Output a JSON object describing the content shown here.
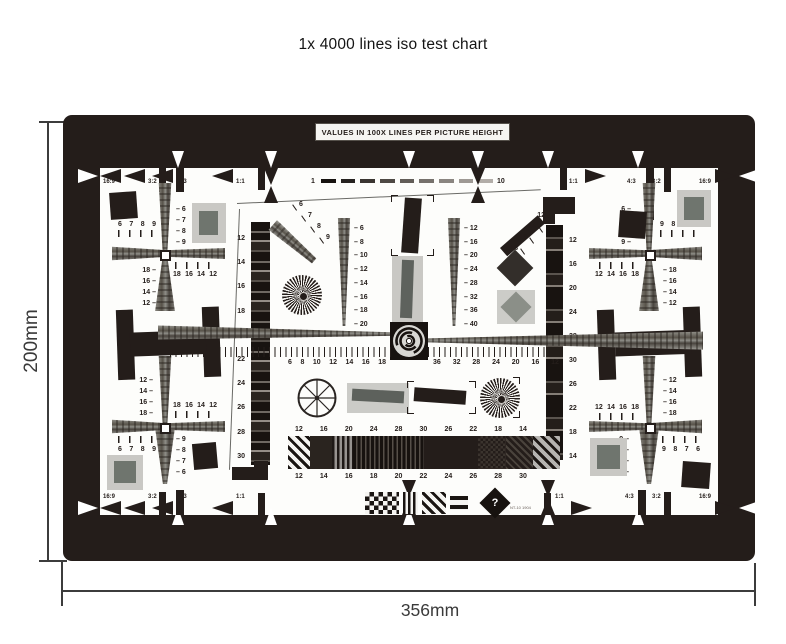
{
  "title": "1x 4000 lines iso test chart",
  "dimensions": {
    "height": "200mm",
    "width": "356mm"
  },
  "chart": {
    "header": "VALUES IN 100X LINES PER PICTURE HEIGHT",
    "scale": {
      "start": "1",
      "end": "10"
    },
    "aspect": {
      "a169": "16:9",
      "a32": "3:2",
      "a43": "4:3",
      "a11": "1:1"
    },
    "corners": {
      "tl": {
        "nw": [
          "6",
          "7",
          "8",
          "9"
        ],
        "ne": [
          "6",
          "7",
          "8",
          "9"
        ],
        "sw": [
          "18",
          "16",
          "14",
          "12"
        ],
        "se": [
          "18",
          "16",
          "14",
          "12"
        ]
      },
      "tr": {
        "nw": [
          "6",
          "7",
          "8",
          "9"
        ],
        "ne": [
          "9",
          "8",
          "7",
          "6"
        ],
        "sw": [
          "12",
          "14",
          "16",
          "18"
        ],
        "se": [
          "18",
          "16",
          "14",
          "12"
        ]
      },
      "bl": {
        "nw": [
          "12",
          "14",
          "16",
          "18"
        ],
        "ne": [
          "18",
          "16",
          "14",
          "12"
        ],
        "sw": [
          "6",
          "7",
          "8",
          "9"
        ],
        "se": [
          "9",
          "8",
          "7",
          "6"
        ]
      },
      "br": {
        "nw": [
          "12",
          "14",
          "16",
          "18"
        ],
        "ne": [
          "12",
          "14",
          "16",
          "18"
        ],
        "sw": [
          "9",
          "8",
          "7",
          "6"
        ],
        "se": [
          "9",
          "8",
          "7",
          "6"
        ]
      }
    },
    "center": {
      "left_strip": [
        "12",
        "14",
        "16",
        "18",
        "20",
        "22",
        "24",
        "26",
        "28",
        "30"
      ],
      "right_strip": [
        "12",
        "16",
        "20",
        "24",
        "28",
        "30",
        "26",
        "22",
        "18",
        "14"
      ],
      "left_wedge": [
        "6",
        "8",
        "10",
        "12",
        "14",
        "16",
        "18",
        "20"
      ],
      "right_wedge": [
        "12",
        "16",
        "20",
        "24",
        "28",
        "32",
        "36",
        "40"
      ],
      "diag_left": [
        "6",
        "7",
        "8",
        "9"
      ],
      "diag_right": [
        "12",
        "14",
        "16",
        "18"
      ],
      "ruler_left": [
        "6",
        "8",
        "10",
        "12",
        "14",
        "16",
        "18"
      ],
      "ruler_right": [
        "36",
        "32",
        "28",
        "24",
        "20",
        "16",
        "12"
      ],
      "bar_top": [
        "12",
        "16",
        "20",
        "24",
        "28",
        "30",
        "26",
        "22",
        "18",
        "14"
      ],
      "bar_bottom": [
        "12",
        "14",
        "16",
        "18",
        "20",
        "22",
        "24",
        "26",
        "28",
        "30"
      ],
      "logo_text": "NT-10 1904"
    },
    "colors": {
      "frame": "#241d1a",
      "wedge_gray": "#8b8b87",
      "light_gray": "#cbcbc7",
      "patch_gray": "#6f756e"
    }
  }
}
